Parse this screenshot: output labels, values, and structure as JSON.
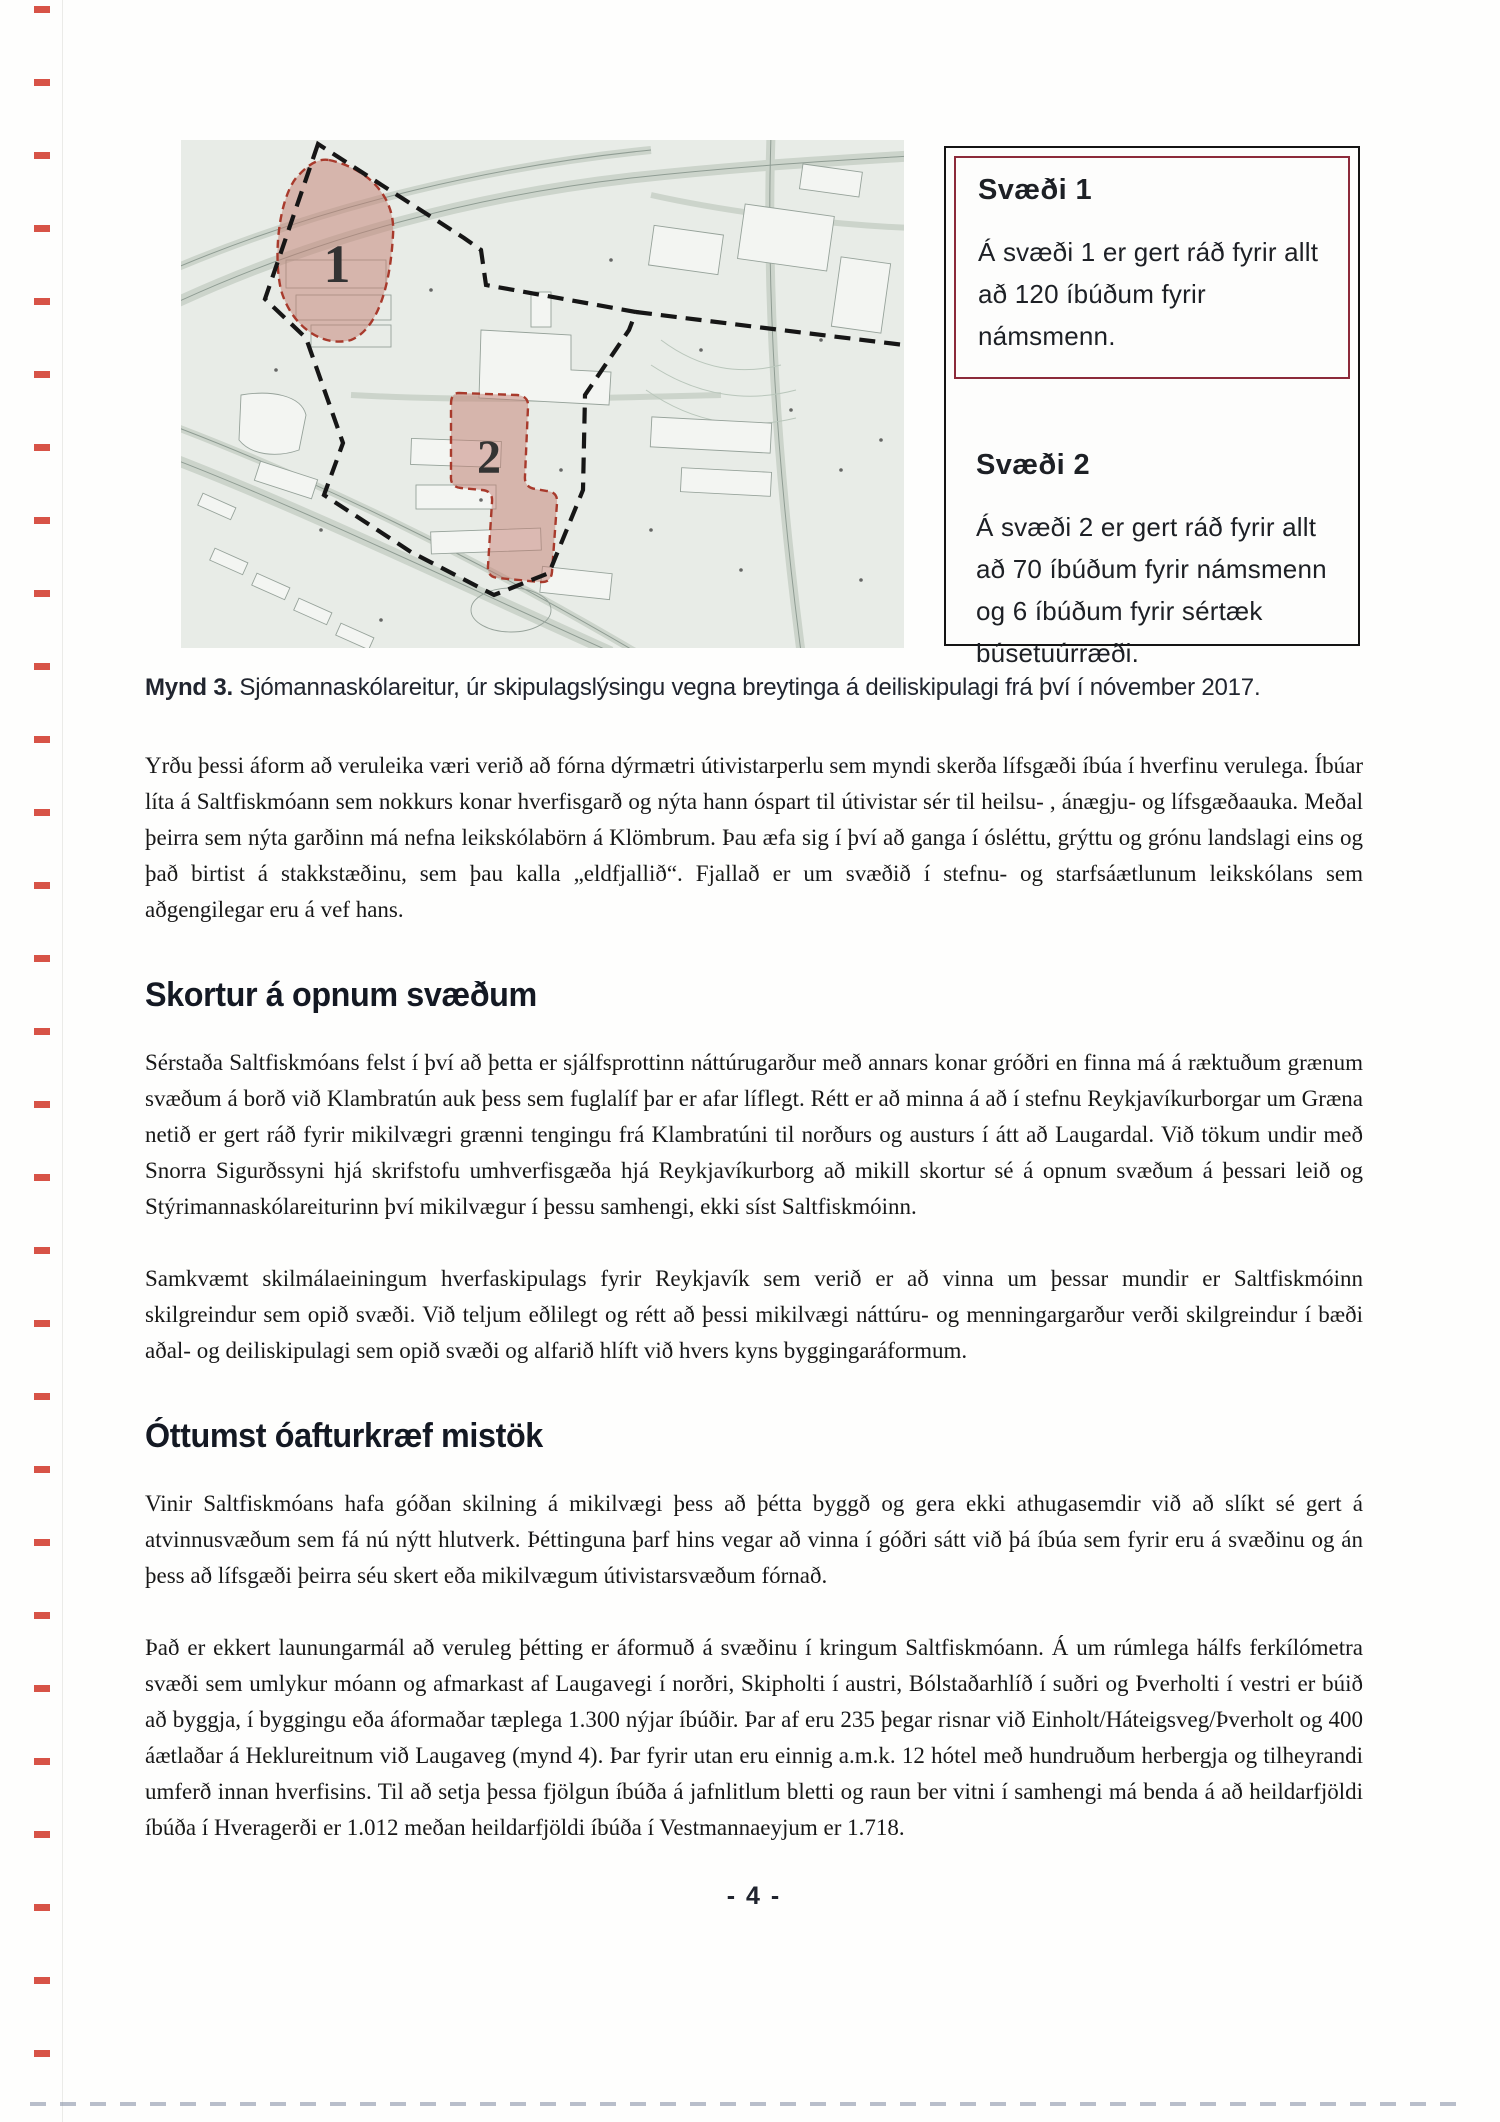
{
  "figure": {
    "map": {
      "area1_label": "1",
      "area2_label": "2"
    },
    "legend": {
      "box1": {
        "title": "Svæði 1",
        "text": "Á svæði 1 er gert ráð fyrir allt að 120 íbúðum fyrir námsmenn."
      },
      "box2": {
        "title": "Svæði 2",
        "text": "Á svæði 2 er gert ráð fyrir allt að 70 íbúðum fyrir námsmenn og 6 íbúðum fyrir sértæk búsetuúrræði."
      }
    },
    "caption": {
      "label": "Mynd 3.",
      "text": " Sjómannaskólareitur, úr skipulagslýsingu vegna breytinga á deiliskipulagi frá því í nóvember 2017."
    }
  },
  "content": {
    "para1": "Yrðu þessi áform að veruleika væri verið að fórna dýrmætri útivistarperlu sem myndi skerða lífsgæði íbúa í hverfinu verulega. Íbúar líta á Saltfiskmóann sem nokkurs konar hverfisgarð og nýta hann óspart til útivistar sér til heilsu- , ánægju- og lífsgæðaauka. Meðal þeirra sem nýta garðinn má nefna leikskólabörn á Klömbrum. Þau æfa sig í því að ganga í ósléttu, grýttu og grónu landslagi eins og það birtist á stakkstæðinu, sem þau kalla „eldfjallið“. Fjallað er um svæðið í stefnu- og starfsáætlunum leikskólans sem aðgengilegar eru á vef hans.",
    "heading1": "Skortur á opnum svæðum",
    "para2": "Sérstaða Saltfiskmóans felst í því að þetta er sjálfsprottinn náttúrugarður með annars konar gróðri en finna má á ræktuðum grænum svæðum á borð við Klambratún auk þess sem fuglalíf þar er afar líflegt. Rétt er að minna á að í stefnu Reykjavíkurborgar um Græna netið er gert ráð fyrir mikilvægri grænni tengingu frá Klambratúni til norðurs og austurs í átt að Laugardal. Við tökum undir með Snorra Sigurðssyni hjá skrifstofu umhverfisgæða hjá Reykjavíkurborg að mikill skortur sé á opnum svæðum á þessari leið og Stýrimannaskólareiturinn því mikilvægur í þessu samhengi, ekki síst Saltfiskmóinn.",
    "para3": "Samkvæmt skilmálaeiningum hverfaskipulags fyrir Reykjavík sem verið er að vinna um þessar mundir er Saltfiskmóinn skilgreindur sem opið svæði. Við teljum eðlilegt og rétt að þessi mikilvægi náttúru- og menningargarður verði skilgreindur í bæði aðal- og deiliskipulagi sem opið svæði og alfarið hlíft við hvers kyns byggingaráformum.",
    "heading2": "Óttumst óafturkræf mistök",
    "para4": "Vinir Saltfiskmóans hafa góðan skilning á mikilvægi þess að þétta byggð og gera ekki athugasemdir við að slíkt sé gert á atvinnusvæðum sem fá nú nýtt hlutverk. Þéttinguna þarf hins vegar að vinna í góðri sátt við þá íbúa sem fyrir eru á svæðinu og án þess að lífsgæði þeirra séu skert eða mikilvægum útivistarsvæðum fórnað.",
    "para5": "Það er ekkert launungarmál að veruleg þétting er áformuð á svæðinu í kringum Saltfiskmóann. Á um rúmlega hálfs ferkílómetra svæði sem umlykur móann og afmarkast af Laugavegi í norðri, Skipholti í austri, Bólstaðarhlíð í suðri og Þverholti í vestri er búið að byggja, í byggingu eða áformaðar tæplega 1.300 nýjar íbúðir. Þar af eru 235 þegar risnar við Einholt/Háteigsveg/Þverholt og 400 áætlaðar á Heklureitnum við Laugaveg (mynd 4). Þar fyrir utan eru einnig a.m.k. 12 hótel með hundruðum herbergja og tilheyrandi umferð innan hverfisins. Til að setja þessa fjölgun íbúða á jafnlitlum bletti og raun ber vitni í samhengi má benda á að heildarfjöldi íbúða í Hveragerði er 1.012 meðan heildarfjöldi íbúða í Vestmannaeyjum er 1.718."
  },
  "footer": {
    "page_number": "- 4 -"
  },
  "colors": {
    "legend_red_border": "#8c2a3a",
    "map_area_fill": "#c47d72",
    "map_area_stroke": "#a83a2c",
    "plan_boundary": "#161616"
  }
}
